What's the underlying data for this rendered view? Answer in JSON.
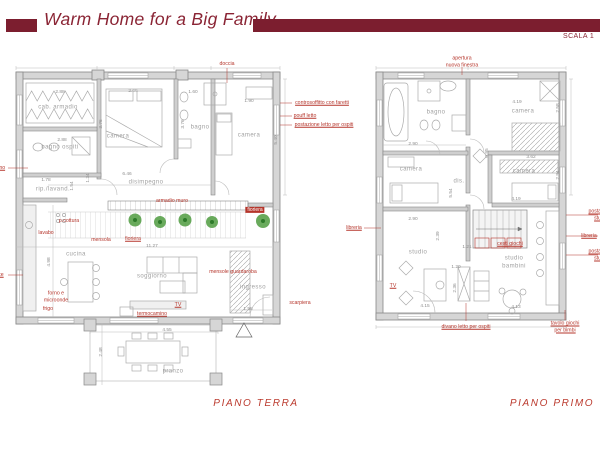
{
  "header": {
    "title": "Warm Home for a Big Family",
    "scale_label": "SCALA 1"
  },
  "colors": {
    "maroon_header": "#7c1e2f",
    "title_text": "#8a2434",
    "annotation_red": "#b5352b",
    "room_label_gray": "#a0a0a0",
    "wall_gray": "#d6d6d6",
    "plant_green": "#4f9b40"
  },
  "plans": [
    {
      "id": "piano-terra",
      "caption": "PIANO TERRA",
      "caption_pos": {
        "x": 256,
        "y": 404
      },
      "rooms": [
        {
          "text": "cab. armadio",
          "x": 58,
          "y": 108
        },
        {
          "text": "bagno ospiti",
          "x": 60,
          "y": 148
        },
        {
          "text": "camera",
          "x": 118,
          "y": 137
        },
        {
          "text": "bagno",
          "x": 200,
          "y": 128
        },
        {
          "text": "camera",
          "x": 249,
          "y": 136
        },
        {
          "text": "disimpegno",
          "x": 146,
          "y": 183
        },
        {
          "text": "rip./lavand.",
          "x": 53,
          "y": 190
        },
        {
          "text": "cucina",
          "x": 76,
          "y": 255
        },
        {
          "text": "soggiorno",
          "x": 152,
          "y": 277
        },
        {
          "text": "ingresso",
          "x": 253,
          "y": 288
        },
        {
          "text": "pranzo",
          "x": 173,
          "y": 372
        }
      ],
      "dimensions": [
        {
          "text": "2.88",
          "x": 60,
          "y": 93
        },
        {
          "text": "2.66",
          "x": 133,
          "y": 92
        },
        {
          "text": "1.60",
          "x": 193,
          "y": 93
        },
        {
          "text": "1.90",
          "x": 249,
          "y": 102
        },
        {
          "text": "3.76",
          "x": 102,
          "y": 124,
          "vertical": true
        },
        {
          "text": "3.76",
          "x": 184,
          "y": 124,
          "vertical": true
        },
        {
          "text": "2.88",
          "x": 62,
          "y": 141
        },
        {
          "text": "5.40",
          "x": 277,
          "y": 140,
          "vertical": true
        },
        {
          "text": "1.78",
          "x": 46,
          "y": 181
        },
        {
          "text": "1.54",
          "x": 73,
          "y": 186,
          "vertical": true
        },
        {
          "text": "1.34",
          "x": 89,
          "y": 178,
          "vertical": true
        },
        {
          "text": "6.46",
          "x": 127,
          "y": 175
        },
        {
          "text": "11.27",
          "x": 152,
          "y": 247
        },
        {
          "text": "4.98",
          "x": 50,
          "y": 262,
          "vertical": true
        },
        {
          "text": "1.58",
          "x": 248,
          "y": 310
        },
        {
          "text": "4.55",
          "x": 167,
          "y": 331
        },
        {
          "text": "2.48",
          "x": 102,
          "y": 352,
          "vertical": true
        }
      ],
      "annotations": [
        {
          "text": "doccia",
          "x": 227,
          "y": 64
        },
        {
          "text": "controsoffitto con faretti",
          "x": 322,
          "y": 103,
          "underline": true
        },
        {
          "text": "pouff letto",
          "x": 305,
          "y": 116,
          "underline": true
        },
        {
          "text": "postazione letto per ospiti",
          "x": 324,
          "y": 125,
          "underline": true
        },
        {
          "text": "armadio muro",
          "x": 172,
          "y": 201
        },
        {
          "text": "fioriera",
          "x": 133,
          "y": 239,
          "underline": true
        },
        {
          "text": "fioriera",
          "x": 255,
          "y": 210,
          "box": true
        },
        {
          "text": "p.cottura",
          "x": 69,
          "y": 221
        },
        {
          "text": "lavabo",
          "x": 46,
          "y": 233
        },
        {
          "text": "mensola",
          "x": 101,
          "y": 240
        },
        {
          "text": "forno e\nmicroonde",
          "x": 56,
          "y": 297
        },
        {
          "text": "frigo",
          "x": 48,
          "y": 309
        },
        {
          "text": "TV",
          "x": 178,
          "y": 305,
          "underline": true
        },
        {
          "text": "termocamino",
          "x": 152,
          "y": 314,
          "underline": true
        },
        {
          "text": "mensole guardaroba",
          "x": 233,
          "y": 272
        },
        {
          "text": "scarpiera",
          "x": 300,
          "y": 303
        },
        {
          "text": "lavandino",
          "x": -6,
          "y": 168,
          "underline": true
        },
        {
          "text": "lavatrice",
          "x": -6,
          "y": 275,
          "underline": true
        }
      ]
    },
    {
      "id": "piano-primo",
      "caption": "PIANO PRIMO",
      "caption_pos": {
        "x": 552,
        "y": 404
      },
      "rooms": [
        {
          "text": "bagno",
          "x": 436,
          "y": 113
        },
        {
          "text": "camera",
          "x": 523,
          "y": 112
        },
        {
          "text": "camera",
          "x": 411,
          "y": 170
        },
        {
          "text": "dis.",
          "x": 459,
          "y": 182
        },
        {
          "text": "camera",
          "x": 524,
          "y": 172
        },
        {
          "text": "studio",
          "x": 418,
          "y": 253
        },
        {
          "text": "studio\nbambini",
          "x": 514,
          "y": 263
        }
      ],
      "dimensions": [
        {
          "text": "2.90",
          "x": 413,
          "y": 145
        },
        {
          "text": "4.19",
          "x": 517,
          "y": 103
        },
        {
          "text": "2.58",
          "x": 559,
          "y": 108,
          "vertical": true
        },
        {
          "text": "3.62",
          "x": 531,
          "y": 158
        },
        {
          "text": "2.94",
          "x": 559,
          "y": 175,
          "vertical": true
        },
        {
          "text": "0.95",
          "x": 488,
          "y": 153,
          "vertical": true
        },
        {
          "text": "5.54",
          "x": 452,
          "y": 193,
          "vertical": true
        },
        {
          "text": "2.90",
          "x": 413,
          "y": 220
        },
        {
          "text": "4.19",
          "x": 516,
          "y": 200
        },
        {
          "text": "2.39",
          "x": 439,
          "y": 236,
          "vertical": true
        },
        {
          "text": "1.21",
          "x": 467,
          "y": 248
        },
        {
          "text": "1.20",
          "x": 456,
          "y": 268
        },
        {
          "text": "2.36",
          "x": 456,
          "y": 288,
          "vertical": true
        },
        {
          "text": "4.15",
          "x": 425,
          "y": 307
        },
        {
          "text": "4.13",
          "x": 516,
          "y": 308
        }
      ],
      "annotations": [
        {
          "text": "apertura\nnuova finestra",
          "x": 462,
          "y": 62
        },
        {
          "text": "libreria",
          "x": 354,
          "y": 228,
          "underline": true
        },
        {
          "text": "TV",
          "x": 393,
          "y": 286,
          "underline": true
        },
        {
          "text": "cesti giochi",
          "x": 510,
          "y": 244,
          "underline": true
        },
        {
          "text": "divano letto per ospiti",
          "x": 466,
          "y": 327,
          "underline": true
        },
        {
          "text": "tavolo giochi per bimbi",
          "x": 565,
          "y": 327,
          "underline": true
        },
        {
          "text": "postazione studio",
          "x": 601,
          "y": 215,
          "underline": true
        },
        {
          "text": "libreria",
          "x": 589,
          "y": 236,
          "underline": true
        },
        {
          "text": "postazione studio",
          "x": 601,
          "y": 255,
          "underline": true
        }
      ]
    }
  ]
}
